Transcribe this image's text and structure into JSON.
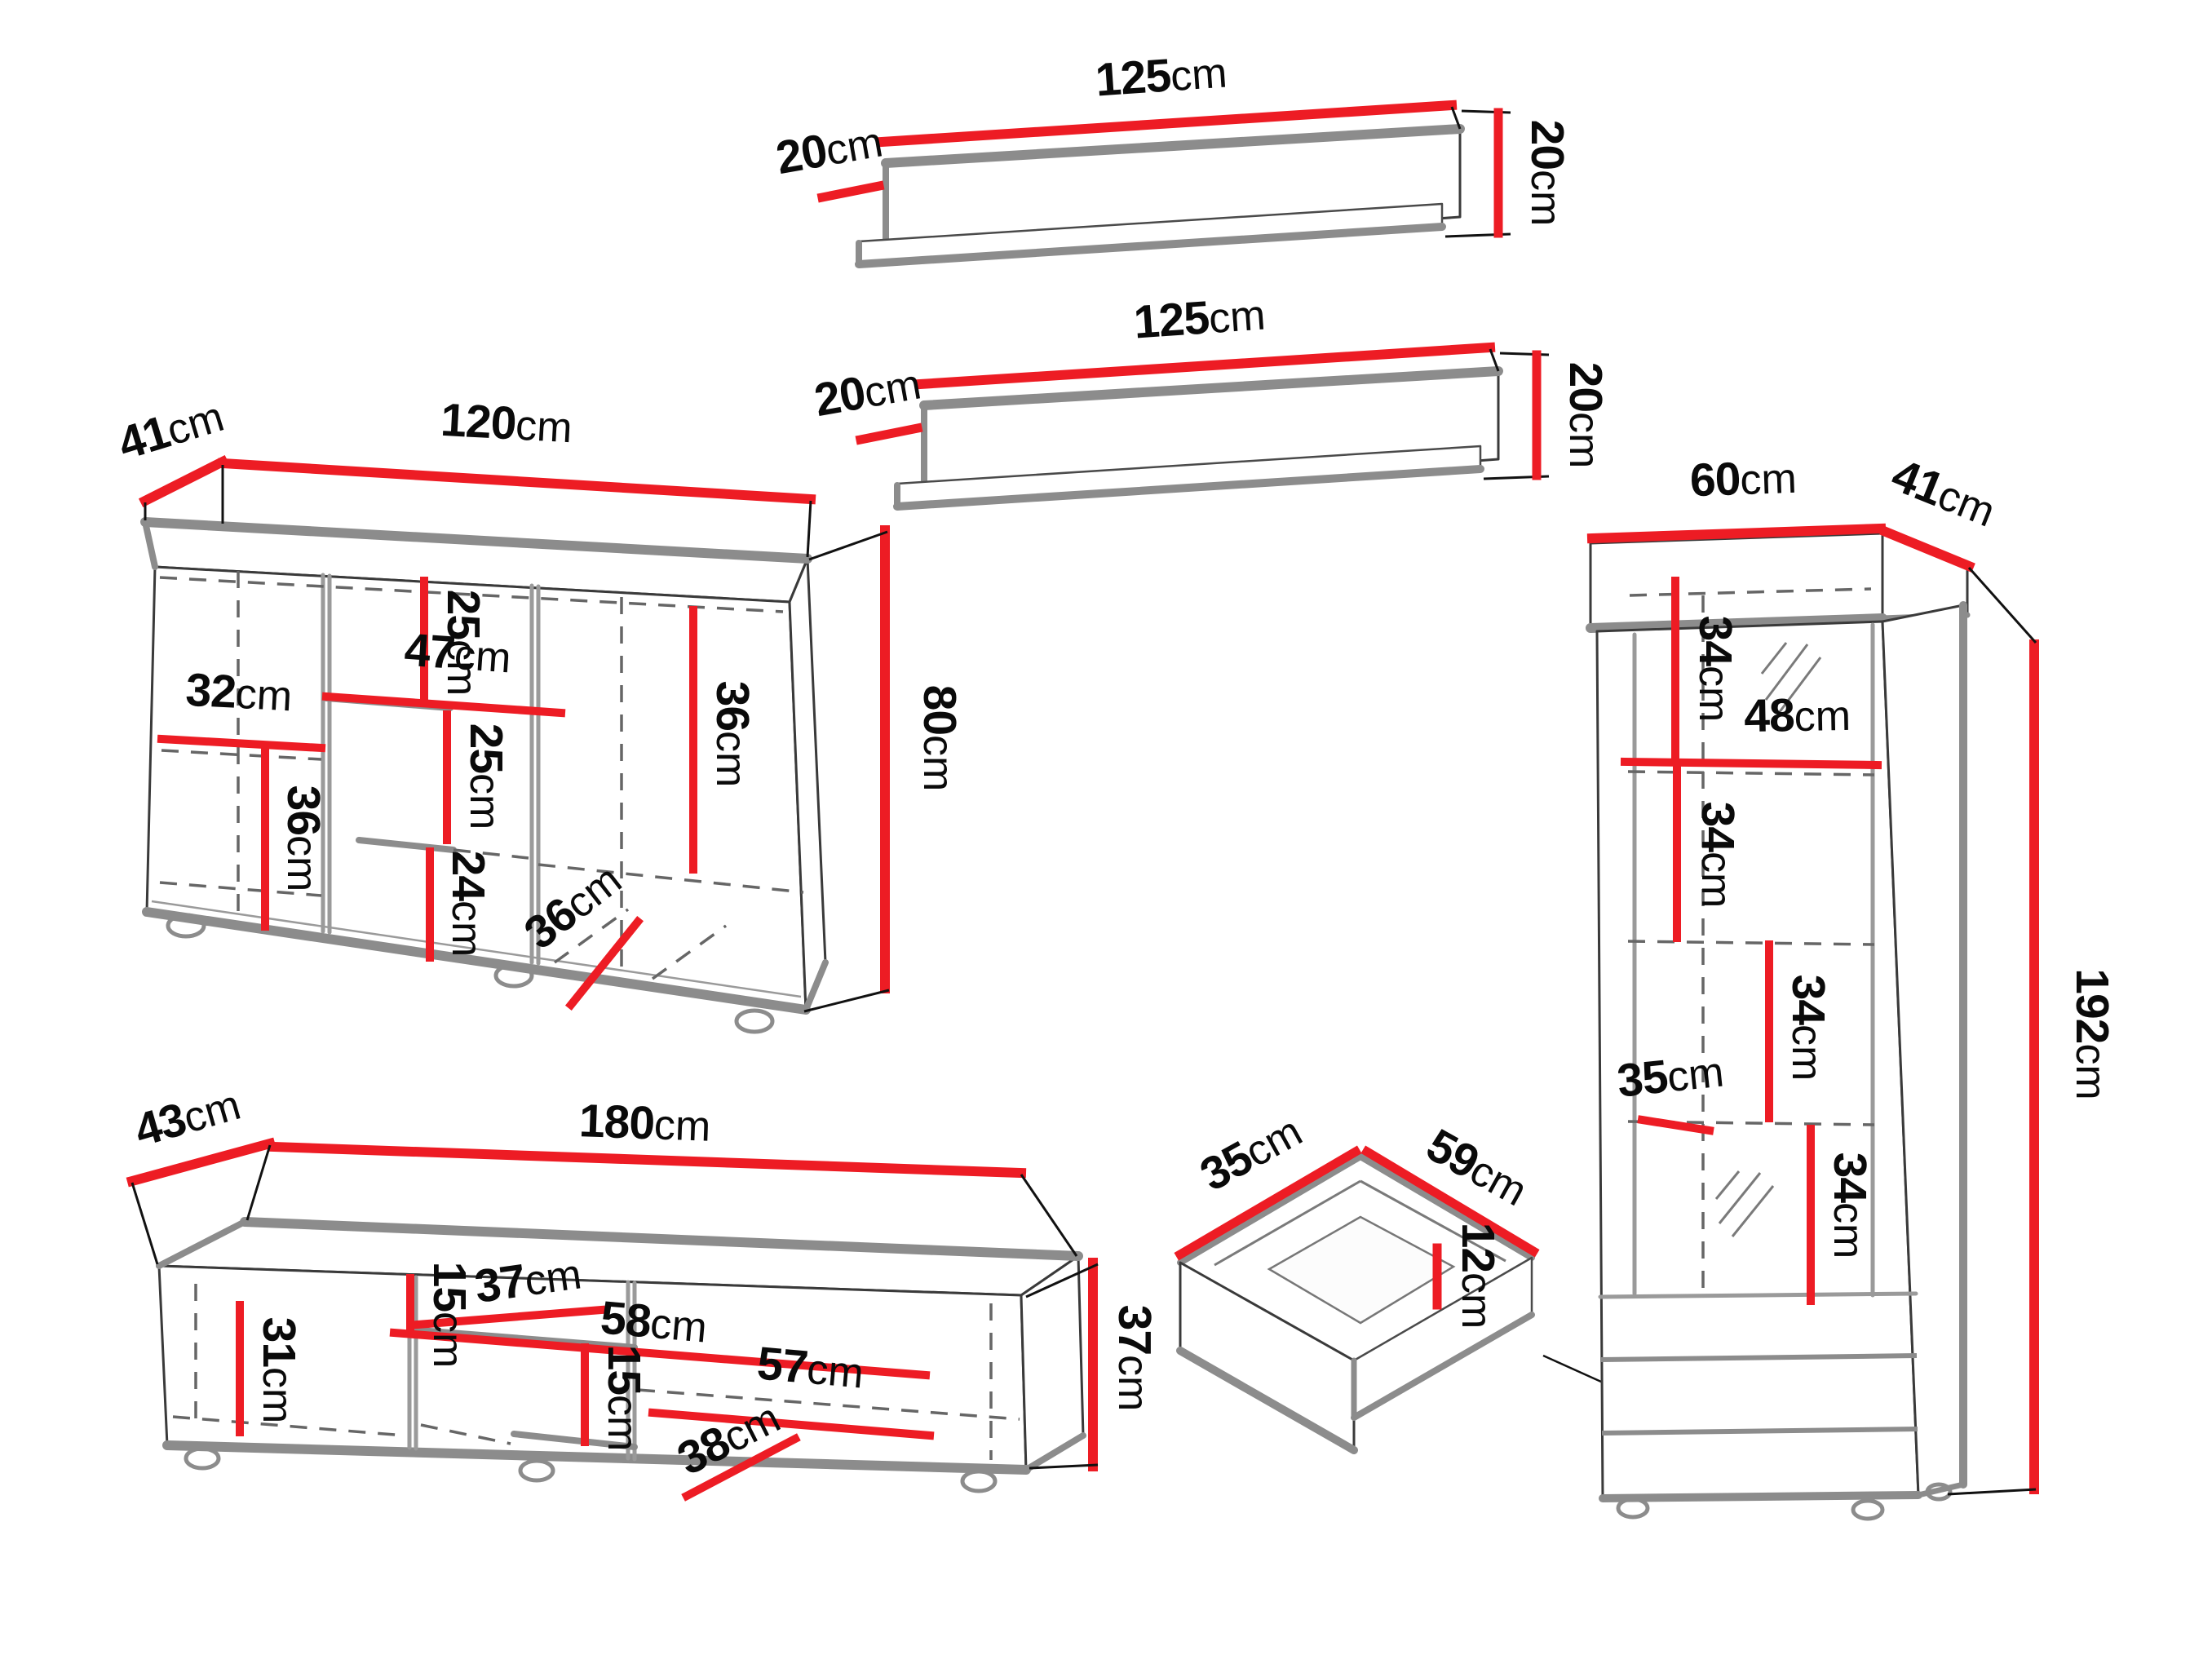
{
  "unit": "cm",
  "colors": {
    "accent_red": "#ed1c24",
    "edge_gray": "#8c8c8c",
    "line_black": "#111111",
    "background": "#ffffff"
  },
  "pieces": {
    "wall_shelf_top": {
      "width": "125",
      "depth": "20",
      "height": "20"
    },
    "wall_shelf_bottom": {
      "width": "125",
      "depth": "20",
      "height": "20"
    },
    "sideboard": {
      "depth": "41",
      "width": "120",
      "height": "80",
      "top_section": "25",
      "mid_shelf_width": "47",
      "mid_section": "25",
      "right_section": "36",
      "left_shelf_width": "32",
      "left_section": "36",
      "bottom_section": "24",
      "inner_depth": "36"
    },
    "tv_stand": {
      "depth": "43",
      "width": "180",
      "height": "37",
      "left_section": "31",
      "top_gap": "15",
      "shelf_depth": "37",
      "shelf_width": "58",
      "right_shelf_width": "57",
      "bottom_gap": "15",
      "inner_depth": "38"
    },
    "drawer": {
      "depth": "35",
      "width": "59",
      "height": "12"
    },
    "cabinet": {
      "width": "60",
      "depth": "41",
      "height": "192",
      "section1": "34",
      "shelf_width": "48",
      "section2": "34",
      "section3": "34",
      "shelf_depth": "35",
      "section4": "34"
    }
  }
}
